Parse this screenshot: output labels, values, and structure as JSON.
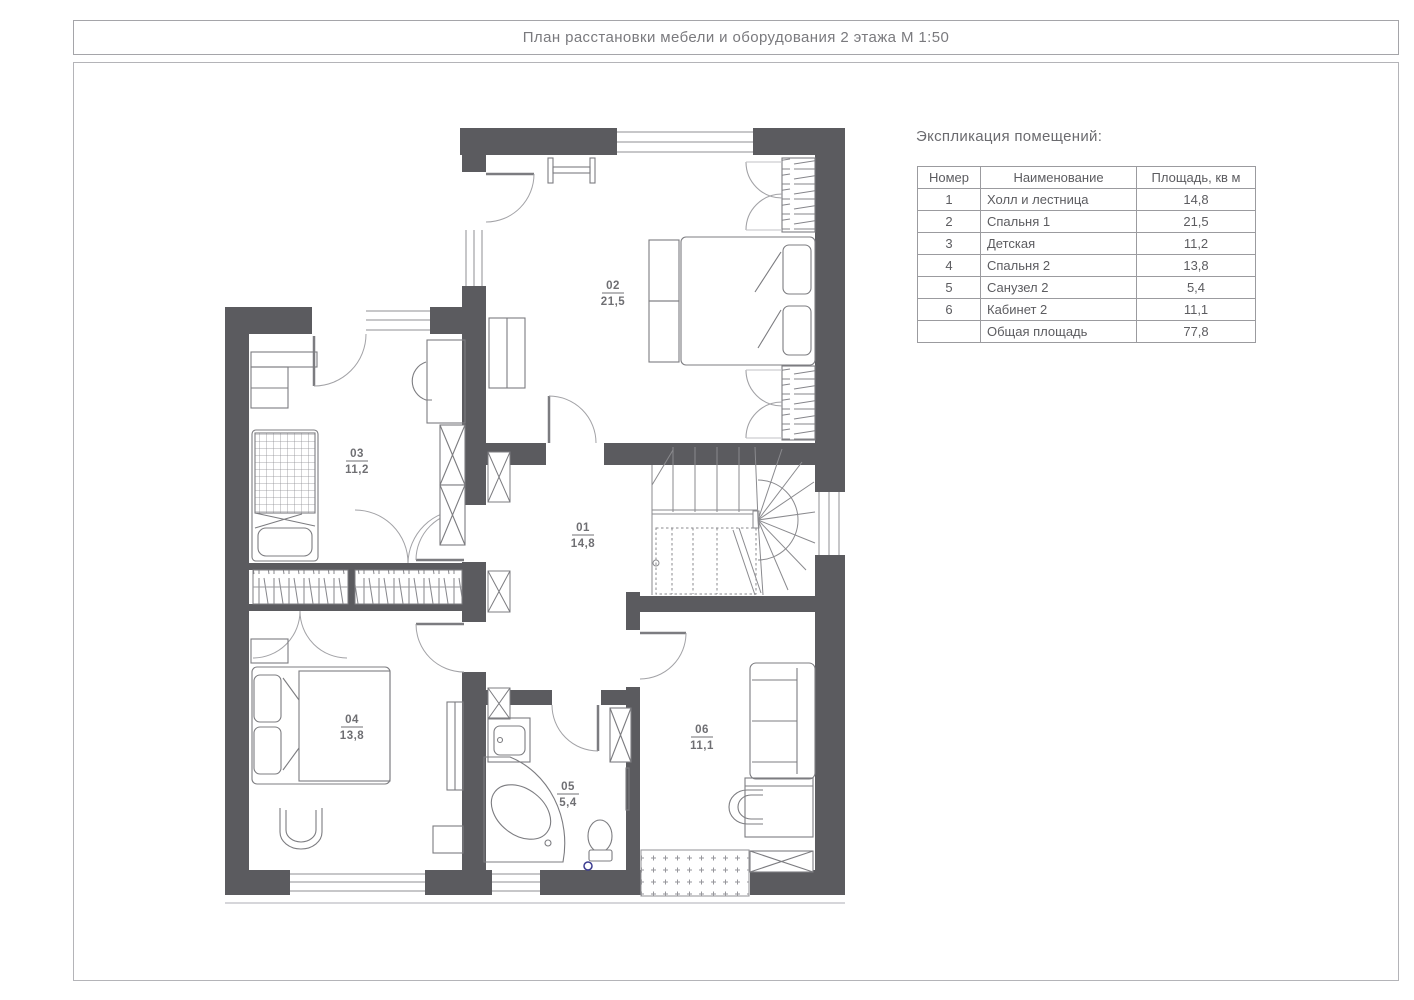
{
  "sheet": {
    "title": "План расстановки мебели и оборудования 2 этажа М 1:50"
  },
  "explication": {
    "heading": "Экспликация помещений:",
    "columns": [
      "Номер",
      "Наименование",
      "Площадь, кв м"
    ],
    "rows": [
      {
        "num": "1",
        "name": "Холл и лестница",
        "area": "14,8"
      },
      {
        "num": "2",
        "name": "Спальня 1",
        "area": "21,5"
      },
      {
        "num": "3",
        "name": "Детская",
        "area": "11,2"
      },
      {
        "num": "4",
        "name": "Спальня 2",
        "area": "13,8"
      },
      {
        "num": "5",
        "name": "Санузел 2",
        "area": "5,4"
      },
      {
        "num": "6",
        "name": "Кабинет 2",
        "area": "11,1"
      },
      {
        "num": "",
        "name": "Общая площадь",
        "area": "77,8"
      }
    ]
  },
  "plan": {
    "scale": "М 1:50",
    "floor": "2 этаж",
    "rooms": [
      {
        "num": "01",
        "area": "14,8"
      },
      {
        "num": "02",
        "area": "21,5"
      },
      {
        "num": "03",
        "area": "11,2"
      },
      {
        "num": "04",
        "area": "13,8"
      },
      {
        "num": "05",
        "area": "5,4"
      },
      {
        "num": "06",
        "area": "11,1"
      }
    ],
    "colors": {
      "wall": "#5b5b5f",
      "furniture_line": "#7c7c80",
      "door_arc": "#a2a2a6",
      "drain": "#3b3b8f"
    }
  }
}
